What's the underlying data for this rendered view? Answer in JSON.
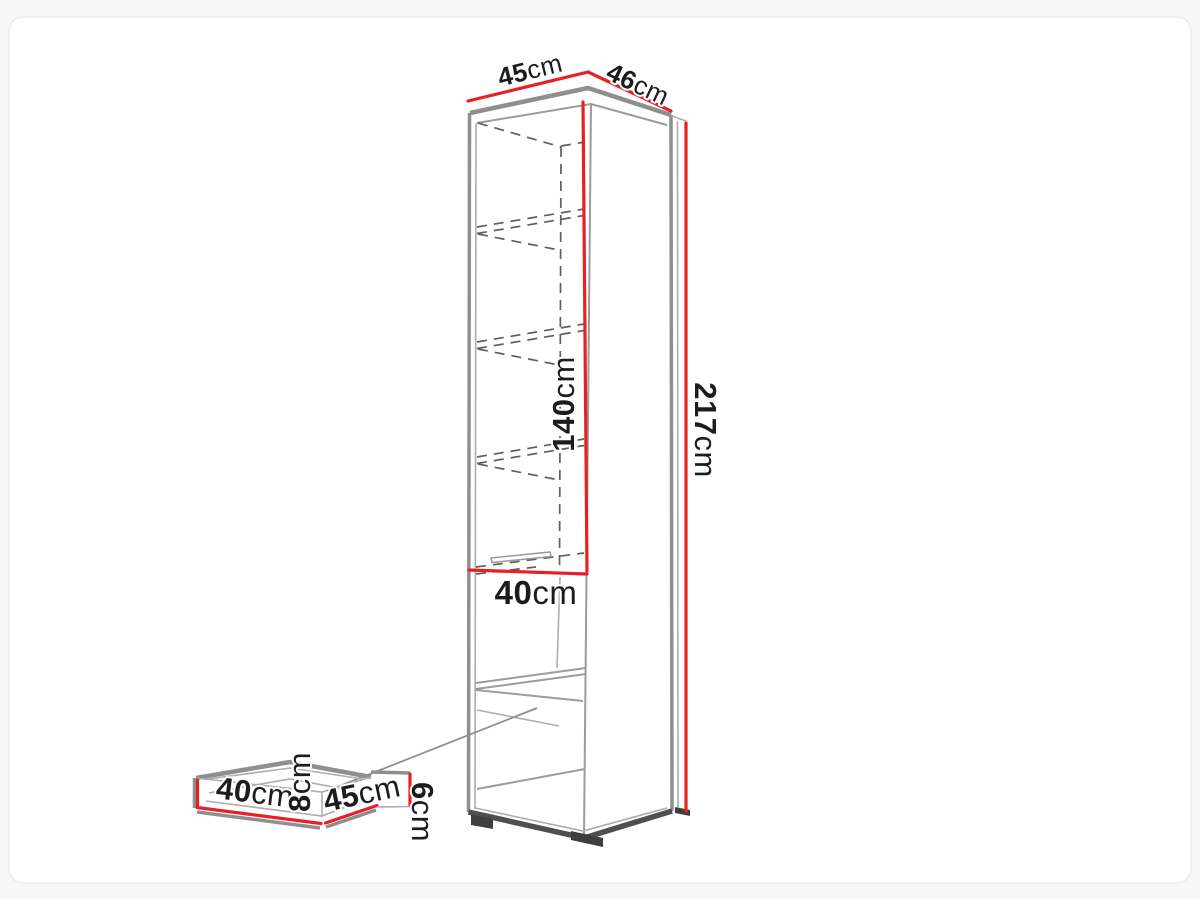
{
  "page": {
    "background": "#f7f7f7",
    "card_background": "#ffffff",
    "card_border": "#ececec"
  },
  "diagram": {
    "kind": "furniture-dimension-drawing",
    "subject": "tall open shelf cabinet with pull-out insert shown separately",
    "colors": {
      "dimension_red": "#e62025",
      "edge_gray": "#8f8f8f",
      "edge_dark": "#4f4f4f",
      "dashed_gray": "#5f5f5f",
      "text": "#1c1c1e"
    },
    "labels": {
      "top_width": {
        "value": "45",
        "unit": "cm"
      },
      "top_depth": {
        "value": "46",
        "unit": "cm"
      },
      "total_height": {
        "value": "217",
        "unit": "cm"
      },
      "interior_height": {
        "value": "140",
        "unit": "cm"
      },
      "interior_width": {
        "value": "40",
        "unit": "cm"
      },
      "insert_width": {
        "value": "40",
        "unit": "cm"
      },
      "insert_depth": {
        "value": "45",
        "unit": "cm"
      },
      "insert_front_height": {
        "value": "8",
        "unit": "cm"
      },
      "insert_side_height": {
        "value": "6",
        "unit": "cm"
      }
    }
  }
}
